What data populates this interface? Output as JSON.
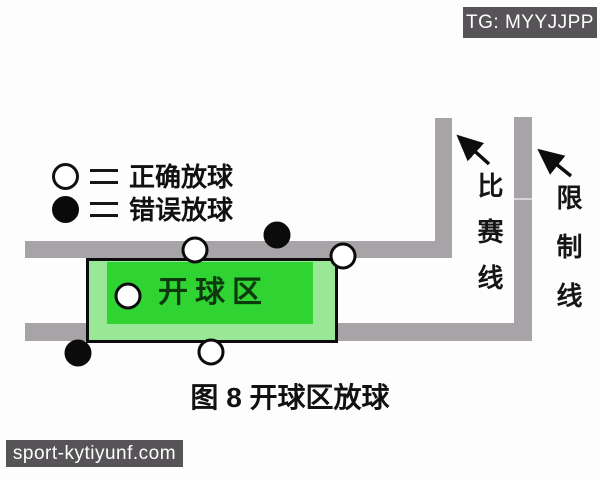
{
  "badge": {
    "text": "TG: MYYJJPP"
  },
  "legend": {
    "items": [
      {
        "symbol": "white-circle",
        "label": "正确放球"
      },
      {
        "symbol": "black-circle",
        "label": "错误放球"
      }
    ]
  },
  "diagram": {
    "start_area_label": "开球区",
    "game_line_label": "比赛线",
    "restriction_line_label": "限制线",
    "caption": "图 8 开球区放球",
    "balls": [
      {
        "name": "ball-correct-on-game-line",
        "type": "correct",
        "x": 195,
        "y": 250
      },
      {
        "name": "ball-wrong-above-game-line",
        "type": "wrong",
        "x": 277,
        "y": 235
      },
      {
        "name": "ball-correct-start-area-corner",
        "type": "correct",
        "x": 343,
        "y": 256
      },
      {
        "name": "ball-correct-inside-start-area",
        "type": "correct",
        "x": 128,
        "y": 296
      },
      {
        "name": "ball-correct-bottom-edge",
        "type": "correct",
        "x": 211,
        "y": 352
      },
      {
        "name": "ball-wrong-outside-left",
        "type": "wrong",
        "x": 78,
        "y": 353
      }
    ],
    "colors": {
      "line_gray": "#a7a3a7",
      "area_light_green": "#98e898",
      "area_bright_green": "#2fd332",
      "label_dark_green": "#0d3a0d",
      "badge_bg": "#575458"
    }
  },
  "watermark": {
    "text": "sport-kytiyunf.com"
  }
}
